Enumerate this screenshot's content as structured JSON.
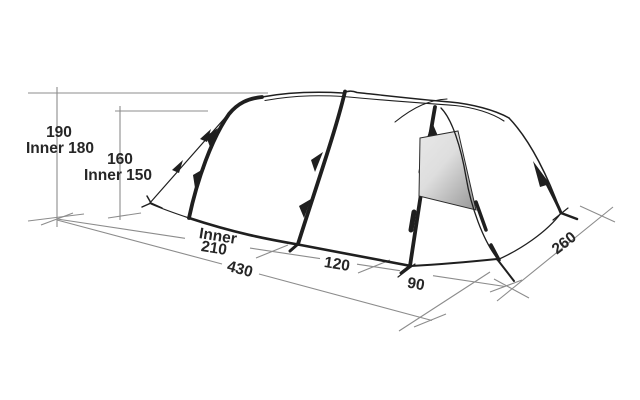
{
  "diagram": {
    "type": "tent-dimension-diagram",
    "background": "#ffffff",
    "line_color": "#1f1f1f",
    "dimension_line_color": "#8c8c8c",
    "text_color": "#262626",
    "window_colors": {
      "light": "#e8e8e8",
      "dark": "#9f9f9f"
    },
    "labels": {
      "peak_height": "190",
      "peak_height_inner": "Inner 180",
      "front_height": "160",
      "front_height_inner": "Inner 150",
      "inner_word": "Inner",
      "inner_length": "210",
      "mid_section_length": "120",
      "door_section_length": "90",
      "total_length": "430",
      "width": "260"
    }
  }
}
